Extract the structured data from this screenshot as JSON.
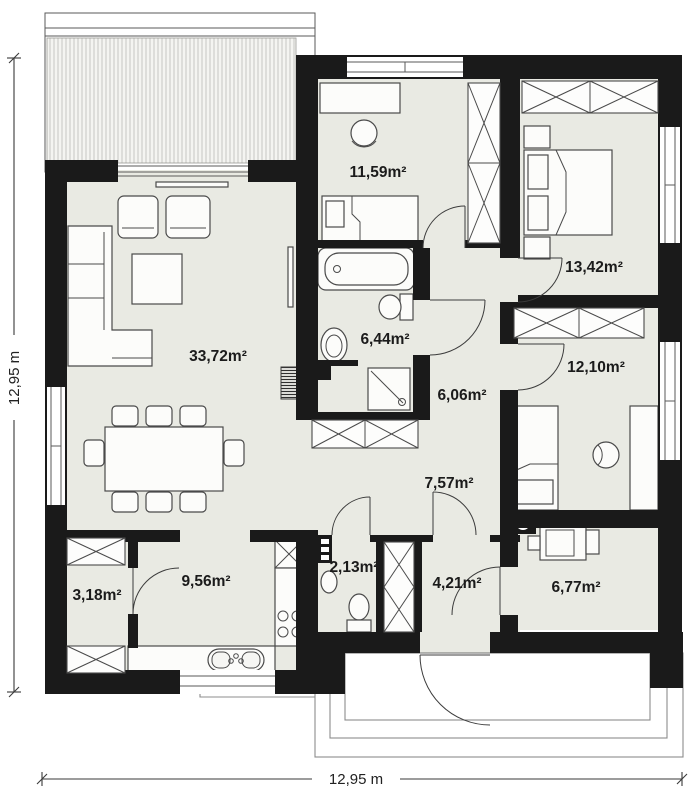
{
  "plan": {
    "type": "single-storey house floor plan",
    "colors": {
      "wall": "#1a1a1a",
      "floor": "#e9eae3",
      "background": "#ffffff",
      "furniture_stroke": "#4a4a4a"
    }
  },
  "rooms": {
    "living": {
      "area": "33,72m²"
    },
    "bedroom_top": {
      "area": "11,59m²"
    },
    "bedroom_right": {
      "area": "13,42m²"
    },
    "bedroom_low": {
      "area": "12,10m²"
    },
    "bathroom": {
      "area": "6,44m²"
    },
    "hallway": {
      "area": "6,06m²"
    },
    "corridor": {
      "area": "7,57m²"
    },
    "kitchen": {
      "area": "9,56m²"
    },
    "pantry": {
      "area": "3,18m²"
    },
    "wc": {
      "area": "2,13m²"
    },
    "entry": {
      "area": "4,21m²"
    },
    "utility": {
      "area": "6,77m²"
    }
  },
  "dimensions": {
    "width": "12,95 m",
    "height": "12,95 m"
  }
}
